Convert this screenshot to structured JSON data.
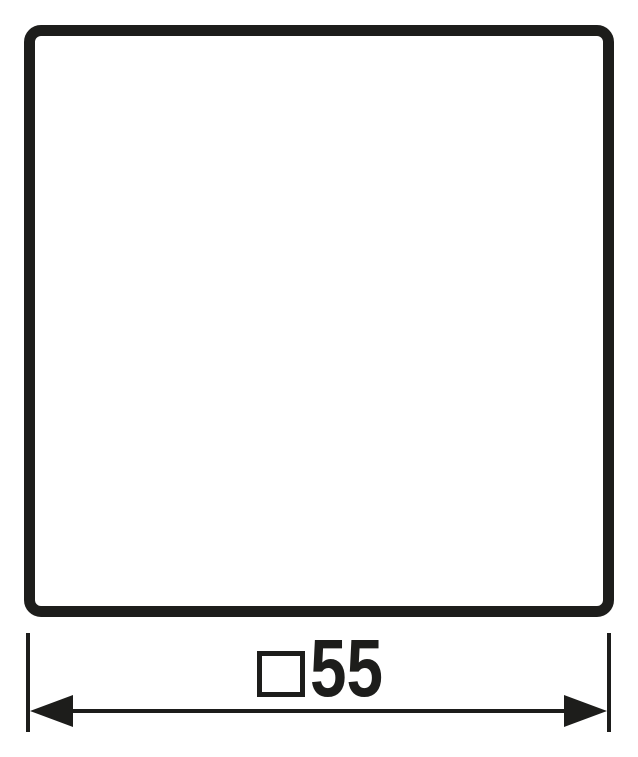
{
  "colors": {
    "ink": "#1d1d1b",
    "background": "#ffffff"
  },
  "drawing": {
    "type": "product-dimension-drawing",
    "plate_shape": "rounded-square"
  },
  "dimension": {
    "symbol": "□",
    "symbol_meaning": "square",
    "value": "55",
    "label": "□55"
  }
}
